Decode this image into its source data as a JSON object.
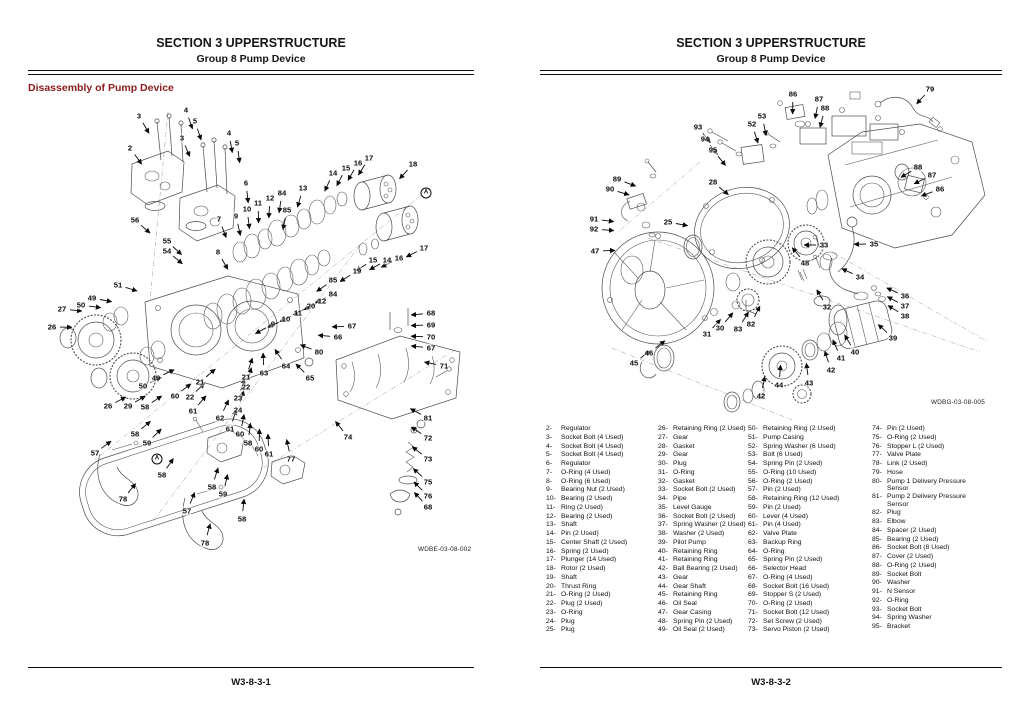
{
  "colors": {
    "heading_red": "#8e1b1b",
    "ink": "#111111"
  },
  "left_page": {
    "header": {
      "section": "SECTION 3 UPPERSTRUCTURE",
      "group": "Group 8 Pump Device"
    },
    "heading": "Disassembly of Pump Device",
    "figure_code": "WDBE-03-08-002",
    "footer": "W3-8-3-1",
    "centroid": {
      "x": 262,
      "y": 330
    },
    "callouts": [
      {
        "t": "3",
        "x": 139,
        "y": 116
      },
      {
        "t": "4",
        "x": 186,
        "y": 110
      },
      {
        "t": "5",
        "x": 195,
        "y": 121
      },
      {
        "t": "2",
        "x": 130,
        "y": 148
      },
      {
        "t": "3",
        "x": 182,
        "y": 138
      },
      {
        "t": "4",
        "x": 229,
        "y": 133
      },
      {
        "t": "5",
        "x": 237,
        "y": 143
      },
      {
        "t": "6",
        "x": 246,
        "y": 183
      },
      {
        "t": "56",
        "x": 135,
        "y": 220
      },
      {
        "t": "7",
        "x": 219,
        "y": 219
      },
      {
        "t": "55",
        "x": 167,
        "y": 241
      },
      {
        "t": "54",
        "x": 167,
        "y": 251
      },
      {
        "t": "8",
        "x": 218,
        "y": 252
      },
      {
        "t": "9",
        "x": 236,
        "y": 216
      },
      {
        "t": "10",
        "x": 247,
        "y": 209
      },
      {
        "t": "11",
        "x": 258,
        "y": 203
      },
      {
        "t": "12",
        "x": 270,
        "y": 198
      },
      {
        "t": "84",
        "x": 282,
        "y": 193
      },
      {
        "t": "85",
        "x": 287,
        "y": 210
      },
      {
        "t": "13",
        "x": 303,
        "y": 188
      },
      {
        "t": "14",
        "x": 333,
        "y": 173
      },
      {
        "t": "15",
        "x": 346,
        "y": 168
      },
      {
        "t": "16",
        "x": 358,
        "y": 163
      },
      {
        "t": "17",
        "x": 369,
        "y": 158
      },
      {
        "t": "18",
        "x": 413,
        "y": 164
      },
      {
        "t": "A",
        "x": 426,
        "y": 193
      },
      {
        "t": "17",
        "x": 424,
        "y": 248
      },
      {
        "t": "15",
        "x": 373,
        "y": 260
      },
      {
        "t": "14",
        "x": 387,
        "y": 260
      },
      {
        "t": "16",
        "x": 399,
        "y": 258
      },
      {
        "t": "19",
        "x": 357,
        "y": 271
      },
      {
        "t": "85",
        "x": 333,
        "y": 280
      },
      {
        "t": "84",
        "x": 333,
        "y": 294
      },
      {
        "t": "12",
        "x": 322,
        "y": 301
      },
      {
        "t": "20",
        "x": 311,
        "y": 306
      },
      {
        "t": "11",
        "x": 298,
        "y": 313
      },
      {
        "t": "10",
        "x": 286,
        "y": 319
      },
      {
        "t": "9",
        "x": 273,
        "y": 324
      },
      {
        "t": "51",
        "x": 118,
        "y": 285
      },
      {
        "t": "49",
        "x": 92,
        "y": 298
      },
      {
        "t": "50",
        "x": 81,
        "y": 305
      },
      {
        "t": "27",
        "x": 62,
        "y": 309
      },
      {
        "t": "26",
        "x": 52,
        "y": 327
      },
      {
        "t": "49",
        "x": 156,
        "y": 378
      },
      {
        "t": "50",
        "x": 143,
        "y": 386
      },
      {
        "t": "26",
        "x": 108,
        "y": 406
      },
      {
        "t": "29",
        "x": 128,
        "y": 406
      },
      {
        "t": "21",
        "x": 200,
        "y": 382
      },
      {
        "t": "22",
        "x": 190,
        "y": 397
      },
      {
        "t": "21",
        "x": 246,
        "y": 377
      },
      {
        "t": "22",
        "x": 246,
        "y": 387
      },
      {
        "t": "23",
        "x": 238,
        "y": 398
      },
      {
        "t": "24",
        "x": 238,
        "y": 410
      },
      {
        "t": "58",
        "x": 145,
        "y": 407
      },
      {
        "t": "60",
        "x": 175,
        "y": 396
      },
      {
        "t": "61",
        "x": 193,
        "y": 411
      },
      {
        "t": "62",
        "x": 220,
        "y": 418
      },
      {
        "t": "58",
        "x": 135,
        "y": 434
      },
      {
        "t": "59",
        "x": 147,
        "y": 443
      },
      {
        "t": "57",
        "x": 95,
        "y": 453
      },
      {
        "t": "58",
        "x": 162,
        "y": 475
      },
      {
        "t": "A",
        "x": 157,
        "y": 459
      },
      {
        "t": "78",
        "x": 123,
        "y": 499
      },
      {
        "t": "61",
        "x": 230,
        "y": 429
      },
      {
        "t": "60",
        "x": 240,
        "y": 434
      },
      {
        "t": "58",
        "x": 248,
        "y": 443
      },
      {
        "t": "60",
        "x": 259,
        "y": 449
      },
      {
        "t": "61",
        "x": 269,
        "y": 454
      },
      {
        "t": "77",
        "x": 291,
        "y": 459
      },
      {
        "t": "57",
        "x": 187,
        "y": 511
      },
      {
        "t": "58",
        "x": 212,
        "y": 487
      },
      {
        "t": "59",
        "x": 223,
        "y": 494
      },
      {
        "t": "58",
        "x": 242,
        "y": 519
      },
      {
        "t": "78",
        "x": 205,
        "y": 543
      },
      {
        "t": "63",
        "x": 264,
        "y": 373
      },
      {
        "t": "64",
        "x": 286,
        "y": 366
      },
      {
        "t": "65",
        "x": 310,
        "y": 378
      },
      {
        "t": "80",
        "x": 319,
        "y": 352
      },
      {
        "t": "66",
        "x": 338,
        "y": 337
      },
      {
        "t": "67",
        "x": 352,
        "y": 326
      },
      {
        "t": "68",
        "x": 431,
        "y": 313
      },
      {
        "t": "69",
        "x": 431,
        "y": 325
      },
      {
        "t": "70",
        "x": 431,
        "y": 337
      },
      {
        "t": "67",
        "x": 431,
        "y": 348
      },
      {
        "t": "71",
        "x": 444,
        "y": 366
      },
      {
        "t": "81",
        "x": 428,
        "y": 418
      },
      {
        "t": "72",
        "x": 428,
        "y": 438
      },
      {
        "t": "73",
        "x": 428,
        "y": 459
      },
      {
        "t": "75",
        "x": 428,
        "y": 482
      },
      {
        "t": "76",
        "x": 428,
        "y": 496
      },
      {
        "t": "68",
        "x": 428,
        "y": 507
      },
      {
        "t": "74",
        "x": 348,
        "y": 437
      }
    ]
  },
  "right_page": {
    "header": {
      "section": "SECTION 3 UPPERSTRUCTURE",
      "group": "Group 8 Pump Device"
    },
    "figure_code": "WDBG-03-08-005",
    "footer": "W3-8-3-2",
    "centroid": {
      "x": 790,
      "y": 245
    },
    "callouts": [
      {
        "t": "86",
        "x": 793,
        "y": 94
      },
      {
        "t": "87",
        "x": 819,
        "y": 99
      },
      {
        "t": "88",
        "x": 825,
        "y": 108
      },
      {
        "t": "79",
        "x": 930,
        "y": 89
      },
      {
        "t": "93",
        "x": 698,
        "y": 127
      },
      {
        "t": "94",
        "x": 705,
        "y": 139
      },
      {
        "t": "95",
        "x": 713,
        "y": 150
      },
      {
        "t": "52",
        "x": 752,
        "y": 124
      },
      {
        "t": "53",
        "x": 762,
        "y": 116
      },
      {
        "t": "89",
        "x": 617,
        "y": 179
      },
      {
        "t": "90",
        "x": 610,
        "y": 189
      },
      {
        "t": "28",
        "x": 713,
        "y": 182
      },
      {
        "t": "91",
        "x": 594,
        "y": 219
      },
      {
        "t": "92",
        "x": 594,
        "y": 229
      },
      {
        "t": "25",
        "x": 668,
        "y": 222
      },
      {
        "t": "47",
        "x": 595,
        "y": 251
      },
      {
        "t": "33",
        "x": 824,
        "y": 245
      },
      {
        "t": "35",
        "x": 874,
        "y": 244
      },
      {
        "t": "34",
        "x": 860,
        "y": 277
      },
      {
        "t": "48",
        "x": 805,
        "y": 263
      },
      {
        "t": "32",
        "x": 827,
        "y": 307
      },
      {
        "t": "36",
        "x": 905,
        "y": 296
      },
      {
        "t": "37",
        "x": 905,
        "y": 306
      },
      {
        "t": "38",
        "x": 905,
        "y": 316
      },
      {
        "t": "39",
        "x": 893,
        "y": 338
      },
      {
        "t": "40",
        "x": 855,
        "y": 352
      },
      {
        "t": "41",
        "x": 841,
        "y": 358
      },
      {
        "t": "42",
        "x": 831,
        "y": 370
      },
      {
        "t": "43",
        "x": 809,
        "y": 383
      },
      {
        "t": "88",
        "x": 918,
        "y": 167
      },
      {
        "t": "87",
        "x": 932,
        "y": 175
      },
      {
        "t": "86",
        "x": 940,
        "y": 189
      },
      {
        "t": "30",
        "x": 720,
        "y": 328
      },
      {
        "t": "31",
        "x": 707,
        "y": 334
      },
      {
        "t": "83",
        "x": 738,
        "y": 329
      },
      {
        "t": "82",
        "x": 751,
        "y": 324
      },
      {
        "t": "46",
        "x": 649,
        "y": 353
      },
      {
        "t": "45",
        "x": 634,
        "y": 363
      },
      {
        "t": "44",
        "x": 779,
        "y": 385
      },
      {
        "t": "42",
        "x": 761,
        "y": 396
      }
    ],
    "parts_columns": [
      [
        {
          "n": "2-",
          "t": "Regulator"
        },
        {
          "n": "3-",
          "t": "Socket Bolt (4 Used)"
        },
        {
          "n": "4-",
          "t": "Socket Bolt (4 Used)"
        },
        {
          "n": "5-",
          "t": "Socket Bolt (4 Used)"
        },
        {
          "n": "6-",
          "t": "Regulator"
        },
        {
          "n": "7-",
          "t": "O-Ring (4 Used)"
        },
        {
          "n": "8-",
          "t": "O-Ring (6 Used)"
        },
        {
          "n": "9-",
          "t": "Bearing Nut (2 Used)"
        },
        {
          "n": "10-",
          "t": "Bearing (2 Used)"
        },
        {
          "n": "11-",
          "t": "Ring (2 Used)"
        },
        {
          "n": "12-",
          "t": "Bearing (2 Used)"
        },
        {
          "n": "13-",
          "t": "Shaft"
        },
        {
          "n": "14-",
          "t": "Pin (2 Used)"
        },
        {
          "n": "15-",
          "t": "Center Shaft (2 Used)"
        },
        {
          "n": "16-",
          "t": "Spring (2 Used)"
        },
        {
          "n": "17-",
          "t": "Plunger (14 Used)"
        },
        {
          "n": "18-",
          "t": "Rotor (2 Used)"
        },
        {
          "n": "19-",
          "t": "Shaft"
        },
        {
          "n": "20-",
          "t": "Thrust Ring"
        },
        {
          "n": "21-",
          "t": "O-Ring (2 Used)"
        },
        {
          "n": "22-",
          "t": "Plug (2 Used)"
        },
        {
          "n": "23-",
          "t": "O-Ring"
        },
        {
          "n": "24-",
          "t": "Plug"
        },
        {
          "n": "25-",
          "t": "Plug"
        }
      ],
      [
        {
          "n": "26-",
          "t": "Retaining Ring (2 Used)"
        },
        {
          "n": "27-",
          "t": "Gear"
        },
        {
          "n": "28-",
          "t": "Gasket"
        },
        {
          "n": "29-",
          "t": "Gear"
        },
        {
          "n": "30-",
          "t": "Plug"
        },
        {
          "n": "31-",
          "t": "O-Ring"
        },
        {
          "n": "32-",
          "t": "Gasket"
        },
        {
          "n": "33-",
          "t": "Socket Bolt (2 Used)"
        },
        {
          "n": "34-",
          "t": "Pipe"
        },
        {
          "n": "35-",
          "t": "Level Gauge"
        },
        {
          "n": "36-",
          "t": "Socket Bolt (2 Used)"
        },
        {
          "n": "37-",
          "t": "Spring Washer (2 Used)"
        },
        {
          "n": "38-",
          "t": "Washer (2 Used)"
        },
        {
          "n": "39-",
          "t": "Pilot Pump"
        },
        {
          "n": "40-",
          "t": "Retaining Ring"
        },
        {
          "n": "41-",
          "t": "Retaining Ring"
        },
        {
          "n": "42-",
          "t": "Ball Bearing (2 Used)"
        },
        {
          "n": "43-",
          "t": "Gear"
        },
        {
          "n": "44-",
          "t": "Gear Shaft"
        },
        {
          "n": "45-",
          "t": "Retaining Ring"
        },
        {
          "n": "46-",
          "t": "Oil Seal"
        },
        {
          "n": "47-",
          "t": "Gear Casing"
        },
        {
          "n": "48-",
          "t": "Spring Pin (2 Used)"
        },
        {
          "n": "49-",
          "t": "Oil Seal (2 Used)"
        }
      ],
      [
        {
          "n": "50-",
          "t": "Retaining Ring (2 Used)"
        },
        {
          "n": "51-",
          "t": "Pump Casing"
        },
        {
          "n": "52-",
          "t": "Spring Washer (6 Used)"
        },
        {
          "n": "53-",
          "t": "Bolt (6 Used)"
        },
        {
          "n": "54-",
          "t": "Spring Pin (2 Used)"
        },
        {
          "n": "55-",
          "t": "O-Ring (10 Used)"
        },
        {
          "n": "56-",
          "t": "O-Ring (2 Used)"
        },
        {
          "n": "57-",
          "t": "Pin (2 Used)"
        },
        {
          "n": "58-",
          "t": "Retaining Ring (12 Used)"
        },
        {
          "n": "59-",
          "t": "Pin (2 Used)"
        },
        {
          "n": "60-",
          "t": "Lever (4 Used)"
        },
        {
          "n": "61-",
          "t": "Pin (4 Used)"
        },
        {
          "n": "62-",
          "t": "Valve Plate"
        },
        {
          "n": "63-",
          "t": "Backup Ring"
        },
        {
          "n": "64-",
          "t": "O-Ring"
        },
        {
          "n": "65-",
          "t": "Spring Pin (2 Used)"
        },
        {
          "n": "66-",
          "t": "Selector Head"
        },
        {
          "n": "67-",
          "t": "O-Ring (4 Used)"
        },
        {
          "n": "68-",
          "t": "Socket Bolt (16 Used)"
        },
        {
          "n": "69-",
          "t": "Stopper S (2 Used)"
        },
        {
          "n": "70-",
          "t": "O-Ring (2 Used)"
        },
        {
          "n": "71-",
          "t": "Socket Bolt (12 Used)"
        },
        {
          "n": "72-",
          "t": "Set Screw (2 Used)"
        },
        {
          "n": "73-",
          "t": "Servo Piston (2 Used)"
        }
      ],
      [
        {
          "n": "74-",
          "t": "Pin (2 Used)"
        },
        {
          "n": "75-",
          "t": "O-Ring (2 Used)"
        },
        {
          "n": "76-",
          "t": "Stopper L (2 Used)"
        },
        {
          "n": "77-",
          "t": "Valve Plate"
        },
        {
          "n": "78-",
          "t": "Link (2 Used)"
        },
        {
          "n": "79-",
          "t": "Hose"
        },
        {
          "n": "80-",
          "t": "Pump 1 Delivery Pressure Sensor"
        },
        {
          "n": "81-",
          "t": "Pump 2 Delivery Pressure Sensor"
        },
        {
          "n": "82-",
          "t": "Plug"
        },
        {
          "n": "83-",
          "t": "Elbow"
        },
        {
          "n": "84-",
          "t": "Spacer (2 Used)"
        },
        {
          "n": "85-",
          "t": "Bearing (2 Used)"
        },
        {
          "n": "86-",
          "t": "Socket Bolt (8 Used)"
        },
        {
          "n": "87-",
          "t": "Cover (2 Used)"
        },
        {
          "n": "88-",
          "t": "O-Ring (2 Used)"
        },
        {
          "n": "89-",
          "t": "Socket Bolt"
        },
        {
          "n": "90-",
          "t": "Washer"
        },
        {
          "n": "91-",
          "t": "N Sensor"
        },
        {
          "n": "92-",
          "t": "O-Ring"
        },
        {
          "n": "93-",
          "t": "Socket Bolt"
        },
        {
          "n": "94-",
          "t": "Spring Washer"
        },
        {
          "n": "95-",
          "t": "Bracket"
        }
      ]
    ]
  }
}
